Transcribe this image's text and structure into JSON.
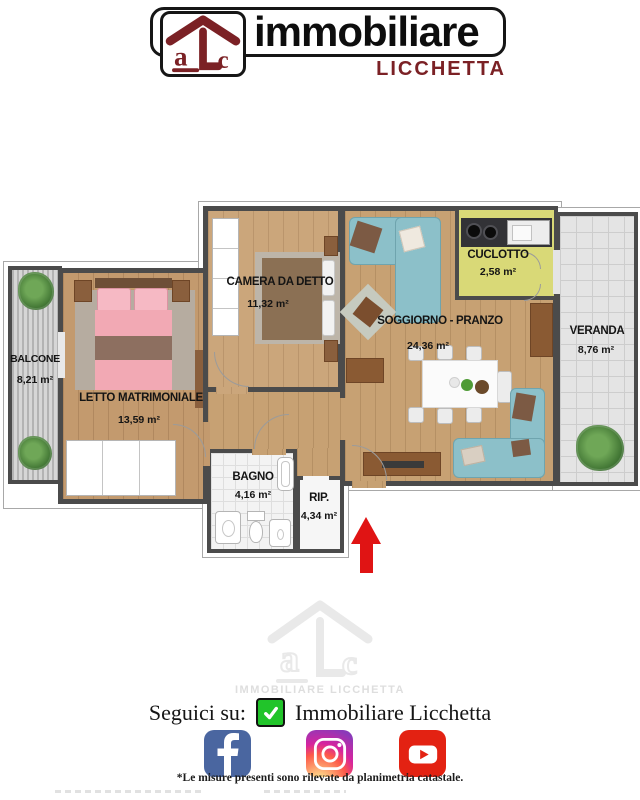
{
  "logo": {
    "brand": "immobiliare",
    "sub_brand": "LICCHETTA",
    "monogram": "alc",
    "brand_color": "#7b2125"
  },
  "floorplan": {
    "rooms": [
      {
        "id": "balcone",
        "label": "BALCONE",
        "area": "8,21 m²"
      },
      {
        "id": "letto",
        "label": "LETTO MATRIMONIALE",
        "area": "13,59 m²"
      },
      {
        "id": "camera",
        "label": "CAMERA DA DETTO",
        "area": "11,32 m²"
      },
      {
        "id": "soggiorno",
        "label": "SOGGIORNO - PRANZO",
        "area": "24,36 m²"
      },
      {
        "id": "cuciotto",
        "label": "CUCLOTTO",
        "area": "2,58 m²"
      },
      {
        "id": "veranda",
        "label": "VERANDA",
        "area": "8,76 m²"
      },
      {
        "id": "bagno",
        "label": "BAGNO",
        "area": "4,16 m²"
      },
      {
        "id": "rip",
        "label": "RIP.",
        "area": "4,34 m²"
      }
    ],
    "entrance_arrow_color": "#e01414"
  },
  "watermark": {
    "monogram": "alc",
    "caption": "IMMOBILIARE LICCHETTA"
  },
  "follow": {
    "prompt": "Seguici su:",
    "account": "Immobiliare Licchetta",
    "check_color": "#21c42a"
  },
  "social": {
    "icons": [
      "facebook",
      "instagram",
      "youtube"
    ],
    "facebook_color": "#4a66a0",
    "youtube_color": "#e32212"
  },
  "footer": {
    "note": "*Le misure presenti sono rilevate da planimetria catastale."
  }
}
